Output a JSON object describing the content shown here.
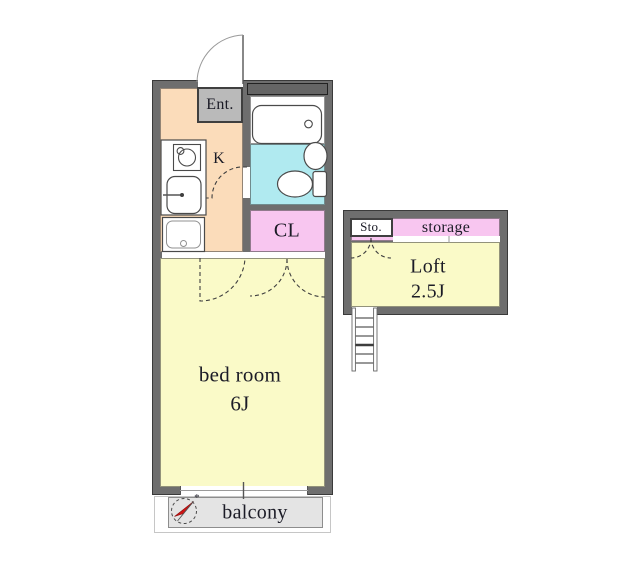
{
  "rooms": {
    "entrance_label": "Ent.",
    "kitchen_label": "K",
    "closet_label": "CL",
    "bedroom_label": "bed room",
    "bedroom_size": "6J",
    "storage_small_label": "Sto.",
    "storage_label": "storage",
    "loft_label": "Loft",
    "loft_size": "2.5J",
    "balcony_label": "balcony",
    "compass_mark": "*"
  },
  "colors": {
    "wall": "#6e6e6e",
    "wall_edge": "#3a3a3a",
    "kitchen_floor": "#fbdcba",
    "bath_floor": "#b0eaf0",
    "closet_pink": "#f8c6f0",
    "room_yellow": "#fafac8",
    "entrance_gray": "#bababa",
    "balcony_gray": "#e4e4e4",
    "compass_red": "#cf1313",
    "text": "#1b1b26",
    "line": "#3f3f3f",
    "fixture_stroke": "#4a4a4a"
  }
}
